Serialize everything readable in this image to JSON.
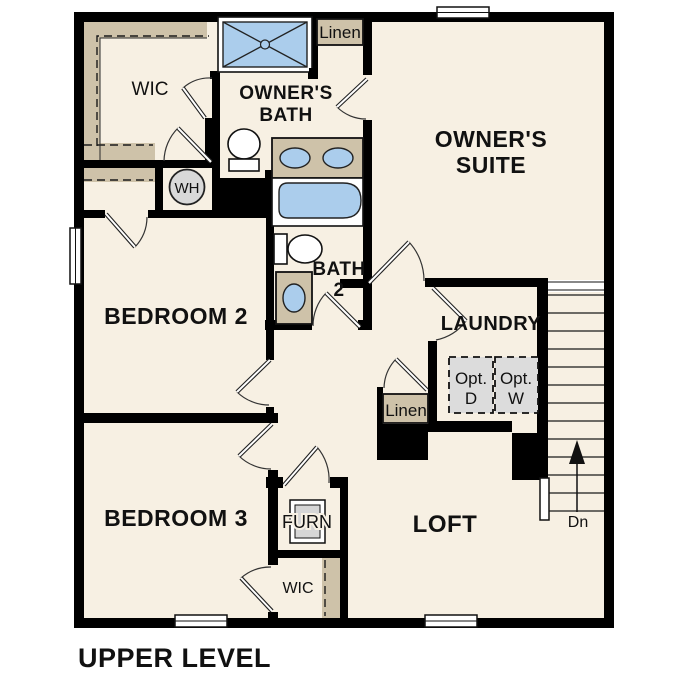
{
  "page_title": "UPPER LEVEL",
  "colors": {
    "floor": "#f7f0e3",
    "wall": "#000000",
    "shelf_tan": "#cec2a9",
    "fixture_blue": "#abcdec",
    "appliance_gray": "#dcdcdc",
    "water_heater_gray": "#d9d9d9"
  },
  "rooms": {
    "wic_top": {
      "label": "WIC"
    },
    "owners_bath": {
      "line1": "OWNER'S",
      "line2": "BATH"
    },
    "linen_top": {
      "label": "Linen"
    },
    "owners_suite": {
      "line1": "OWNER'S",
      "line2": "SUITE"
    },
    "bedroom2": {
      "label": "BEDROOM 2"
    },
    "bath2": {
      "line1": "BATH",
      "line2": "2"
    },
    "laundry": {
      "label": "LAUNDRY"
    },
    "bedroom3": {
      "label": "BEDROOM 3"
    },
    "loft": {
      "label": "LOFT"
    },
    "wic_bottom": {
      "label": "WIC"
    },
    "linen_lower": {
      "label": "Linen"
    },
    "furnace_closet": {
      "label": "FURN"
    }
  },
  "fixtures": {
    "water_heater": {
      "label": "WH"
    },
    "optional_dryer": {
      "line1": "Opt.",
      "line2": "D"
    },
    "optional_washer": {
      "line1": "Opt.",
      "line2": "W"
    },
    "stairs": {
      "direction_label": "Dn"
    }
  }
}
